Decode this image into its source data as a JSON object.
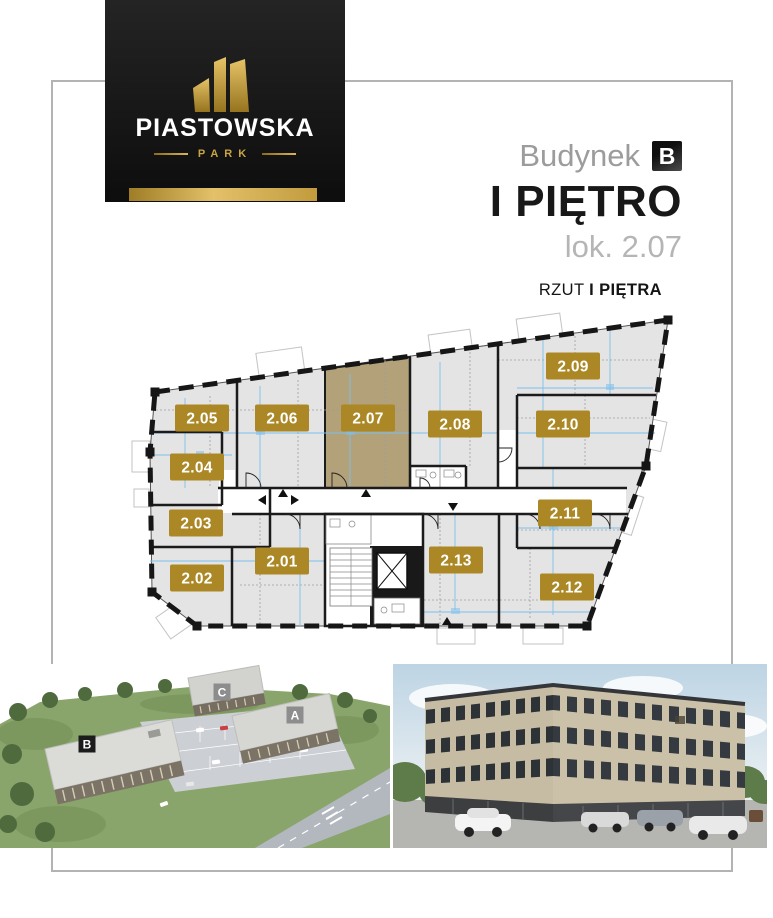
{
  "brand": {
    "name": "PIASTOWSKA",
    "subtitle": "PARK"
  },
  "header": {
    "building_label": "Budynek",
    "building_letter": "B",
    "floor_title": "I PIĘTRO",
    "unit_label": "lok. 2.07",
    "plan_caption_regular": "RZUT",
    "plan_caption_bold": "I PIĘTRA"
  },
  "floor_plan": {
    "highlighted_unit": "2.07",
    "badge_color": "#ab8825",
    "highlight_fill": "#b2a179",
    "room_fill": "#e4e4e4",
    "wall_color": "#1b1b1b",
    "dimension_line_color": "#7cc0ee",
    "units": [
      {
        "id": "2.01",
        "x": 282,
        "y": 561
      },
      {
        "id": "2.02",
        "x": 197,
        "y": 578
      },
      {
        "id": "2.03",
        "x": 196,
        "y": 523
      },
      {
        "id": "2.04",
        "x": 197,
        "y": 467
      },
      {
        "id": "2.05",
        "x": 202,
        "y": 418
      },
      {
        "id": "2.06",
        "x": 282,
        "y": 418
      },
      {
        "id": "2.07",
        "x": 368,
        "y": 418
      },
      {
        "id": "2.08",
        "x": 455,
        "y": 424
      },
      {
        "id": "2.09",
        "x": 573,
        "y": 366
      },
      {
        "id": "2.10",
        "x": 563,
        "y": 424
      },
      {
        "id": "2.11",
        "x": 565,
        "y": 513
      },
      {
        "id": "2.12",
        "x": 567,
        "y": 587
      },
      {
        "id": "2.13",
        "x": 456,
        "y": 560
      }
    ]
  },
  "site_map": {
    "buildings": [
      {
        "letter": "B",
        "x": 87,
        "y": 80,
        "style": "dark"
      },
      {
        "letter": "C",
        "x": 222,
        "y": 28,
        "style": "light"
      },
      {
        "letter": "A",
        "x": 295,
        "y": 51,
        "style": "light"
      }
    ]
  }
}
